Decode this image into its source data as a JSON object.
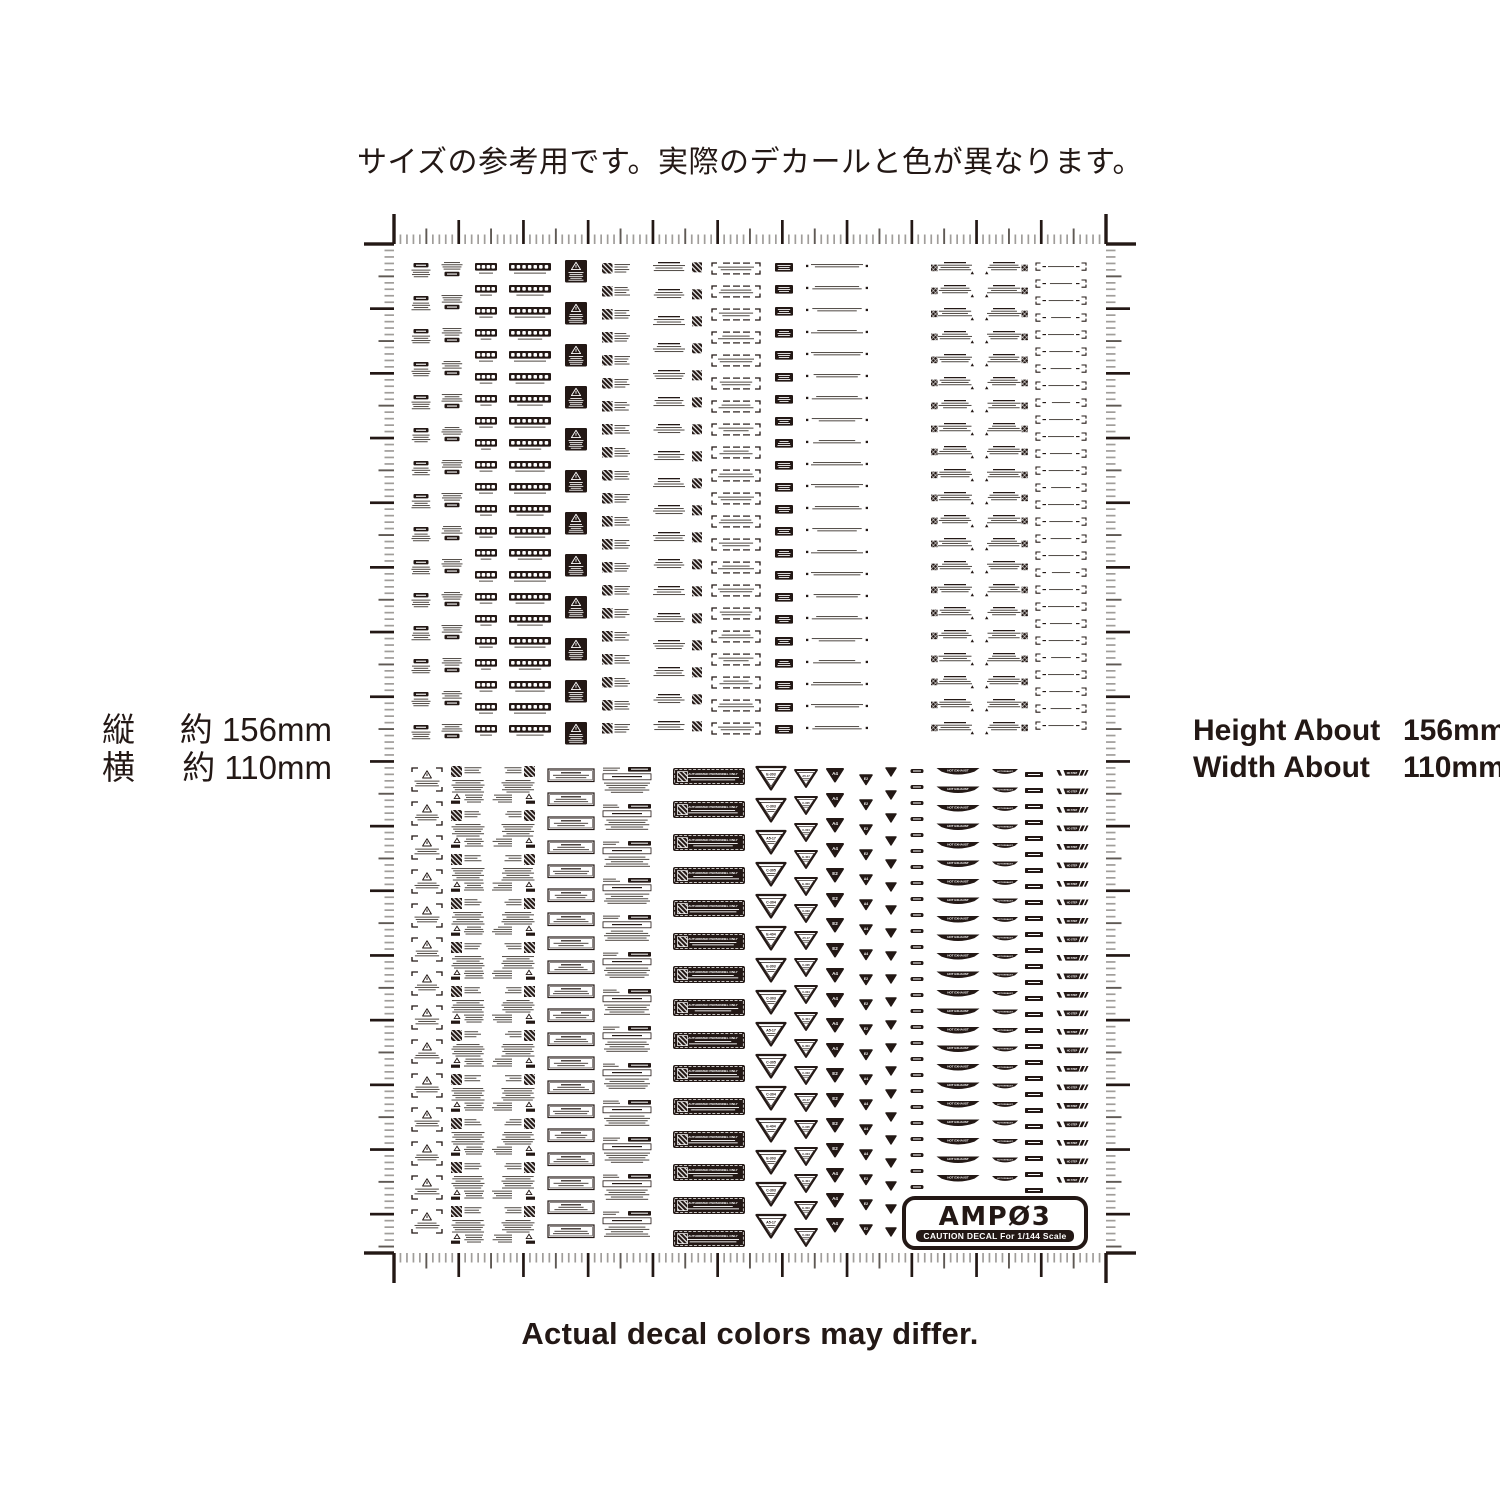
{
  "page": {
    "bg": "#ffffff",
    "ink": "#231815",
    "width": 1500,
    "height": 1500
  },
  "captions": {
    "top": "サイズの参考用です。実際のデカールと色が異なります。",
    "bottom": "Actual decal colors may differ."
  },
  "size_labels": {
    "left": [
      {
        "label": "縦",
        "value": "約 156mm"
      },
      {
        "label": "横",
        "value": "約 110mm"
      }
    ],
    "right": [
      {
        "label": "Height About",
        "value": "156mm"
      },
      {
        "label": "Width About",
        "value": "110mm"
      }
    ]
  },
  "logo": {
    "name": "AMP03",
    "display": "AMPØ3",
    "sub": "CAUTION DECAL For 1/144 Scale"
  },
  "sheet": {
    "bounds": {
      "left": 394,
      "top": 244,
      "right": 1106,
      "bottom": 1253
    },
    "ruler": {
      "width_mm": 110,
      "height_mm": 156,
      "tick_colors": {
        "minor": "#a09d9a",
        "mid": "#5f5954",
        "major": "#231815"
      }
    },
    "decal_text": {
      "caution": "CAUTION",
      "armament": "ARMAMENT SAFETY",
      "authorized": "AUTHORIZED PERSONNEL ONLY",
      "hot_exhaust": "HOT EXHAUST",
      "no_step": "NO STEP",
      "tri_labels": [
        "E-303",
        "C-303",
        "A5-17",
        "C-305",
        "C-304",
        "E-404"
      ],
      "tri_letters": [
        "A4",
        "E2"
      ]
    },
    "top_columns": [
      {
        "type": "caution-tag",
        "cx": 421,
        "y0": 263,
        "pitch": 33,
        "count": 15
      },
      {
        "type": "text-pill",
        "cx": 452,
        "y0": 262,
        "pitch": 33,
        "count": 15
      },
      {
        "type": "chain-s",
        "cx": 486,
        "y0": 263,
        "pitch": 22,
        "count": 22
      },
      {
        "type": "chain-l",
        "cx": 530,
        "y0": 263,
        "pitch": 22,
        "count": 22
      },
      {
        "type": "warn-square",
        "cx": 576,
        "y0": 260,
        "pitch": 42,
        "count": 12
      },
      {
        "type": "stripe-text",
        "cx": 615,
        "y0": 263,
        "pitch": 23,
        "count": 21
      },
      {
        "type": "text-stripe",
        "cx": 677,
        "y0": 262,
        "pitch": 27,
        "count": 18
      },
      {
        "type": "bracket-box",
        "cx": 736,
        "y0": 263,
        "pitch": 23,
        "count": 21
      },
      {
        "type": "mini-black-box",
        "cx": 784,
        "y0": 263,
        "pitch": 22,
        "count": 22
      },
      {
        "type": "dotted-line",
        "cx": 837,
        "y0": 264,
        "pitch": 22,
        "count": 22
      },
      {
        "type": "armament-left",
        "cx": 953,
        "y0": 262,
        "pitch": 23,
        "count": 21
      },
      {
        "type": "armament-right",
        "cx": 1006,
        "y0": 262,
        "pitch": 23,
        "count": 21
      },
      {
        "type": "thin-bracket",
        "cx": 1061,
        "y0": 263,
        "pitch": 17,
        "count": 28
      }
    ],
    "bottom_columns": [
      {
        "type": "tri-bracket",
        "cx": 427,
        "y0": 768,
        "pitch": 34,
        "count": 14
      },
      {
        "type": "stripe-col",
        "cx": 468,
        "y0": 766,
        "pitch": 44,
        "count": 11
      },
      {
        "type": "stripe-col-r",
        "cx": 518,
        "y0": 766,
        "pitch": 44,
        "count": 11
      },
      {
        "type": "armament-box",
        "cx": 571,
        "y0": 769,
        "pitch": 24,
        "count": 20
      },
      {
        "type": "service-text",
        "cx": 627,
        "y0": 767,
        "pitch": 37,
        "count": 13
      },
      {
        "type": "authorized-bar",
        "cx": 709,
        "y0": 768,
        "pitch": 33,
        "count": 15
      },
      {
        "type": "tri-label-l",
        "cx": 771,
        "y0": 767,
        "pitch": 32,
        "count": 15
      },
      {
        "type": "tri-label-s",
        "cx": 806,
        "y0": 770,
        "pitch": 27,
        "count": 18
      },
      {
        "type": "tri-solid-l",
        "cx": 835,
        "y0": 769,
        "pitch": 25,
        "count": 19
      },
      {
        "type": "tri-solid-s",
        "cx": 866,
        "y0": 775,
        "pitch": 25,
        "count": 19
      },
      {
        "type": "tri-plain",
        "cx": 891,
        "y0": 768,
        "pitch": 23,
        "count": 21
      },
      {
        "type": "pill-s",
        "cx": 917,
        "y0": 769,
        "pitch": 16,
        "count": 27
      },
      {
        "type": "hot-exhaust-l",
        "cx": 958,
        "y0": 768,
        "pitch": 18.5,
        "count": 23
      },
      {
        "type": "hot-exhaust-s",
        "cx": 1005,
        "y0": 769,
        "pitch": 18.5,
        "count": 23
      },
      {
        "type": "label-rect",
        "cx": 1034,
        "y0": 772,
        "pitch": 16,
        "count": 27
      },
      {
        "type": "no-step",
        "cx": 1072,
        "y0": 770,
        "pitch": 18.5,
        "count": 23
      }
    ]
  }
}
